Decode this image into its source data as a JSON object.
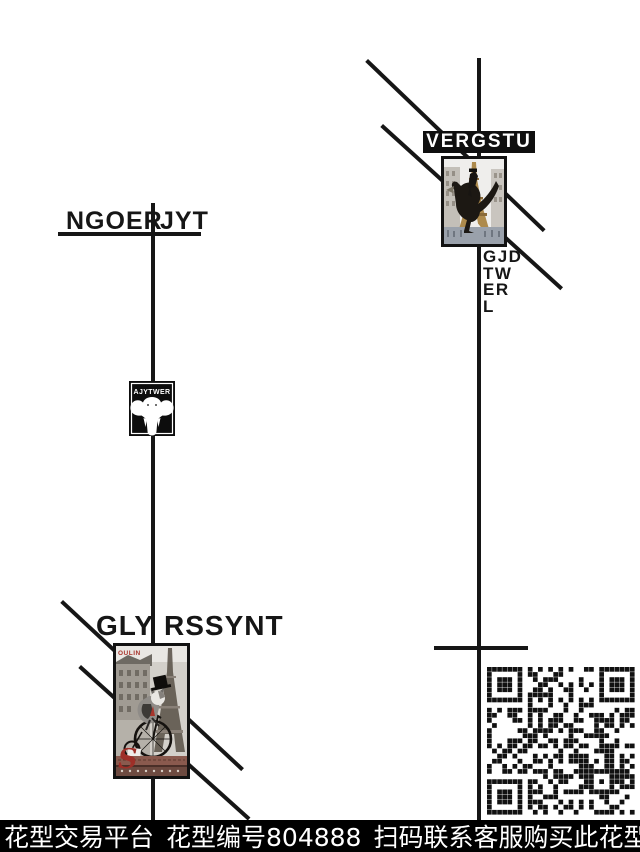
{
  "page": {
    "background": "#ffffff",
    "ink": "#161616",
    "accent_red": "#a8352c",
    "tower_gold": "#ad8a4c"
  },
  "left_group": {
    "title_left": "NGOER",
    "title_right": "JYT",
    "badge": {
      "label": "AJYTWER",
      "icon": "elephant-head"
    },
    "subtitle_left": "GLY",
    "subtitle_right": "RSSYNT",
    "collage": {
      "kind": "photo-collage",
      "subject": "cat in top hat on penny-farthing, Eiffel tower",
      "top_text": "OULIN",
      "corner_initial": "S"
    }
  },
  "right_group": {
    "banner_label": "VERGSTU",
    "vertical_label": [
      "GJD",
      "TW",
      "ER",
      "L"
    ],
    "collage": {
      "kind": "photo-collage",
      "subject": "rider on raptor, gold Eiffel tower"
    }
  },
  "qr": {
    "modules": 29,
    "color": "#111111",
    "seed": 804888
  },
  "footer": {
    "platform": "花型交易平台",
    "pattern_id": "花型编号804888",
    "cta": "扫码联系客服购买此花型"
  }
}
